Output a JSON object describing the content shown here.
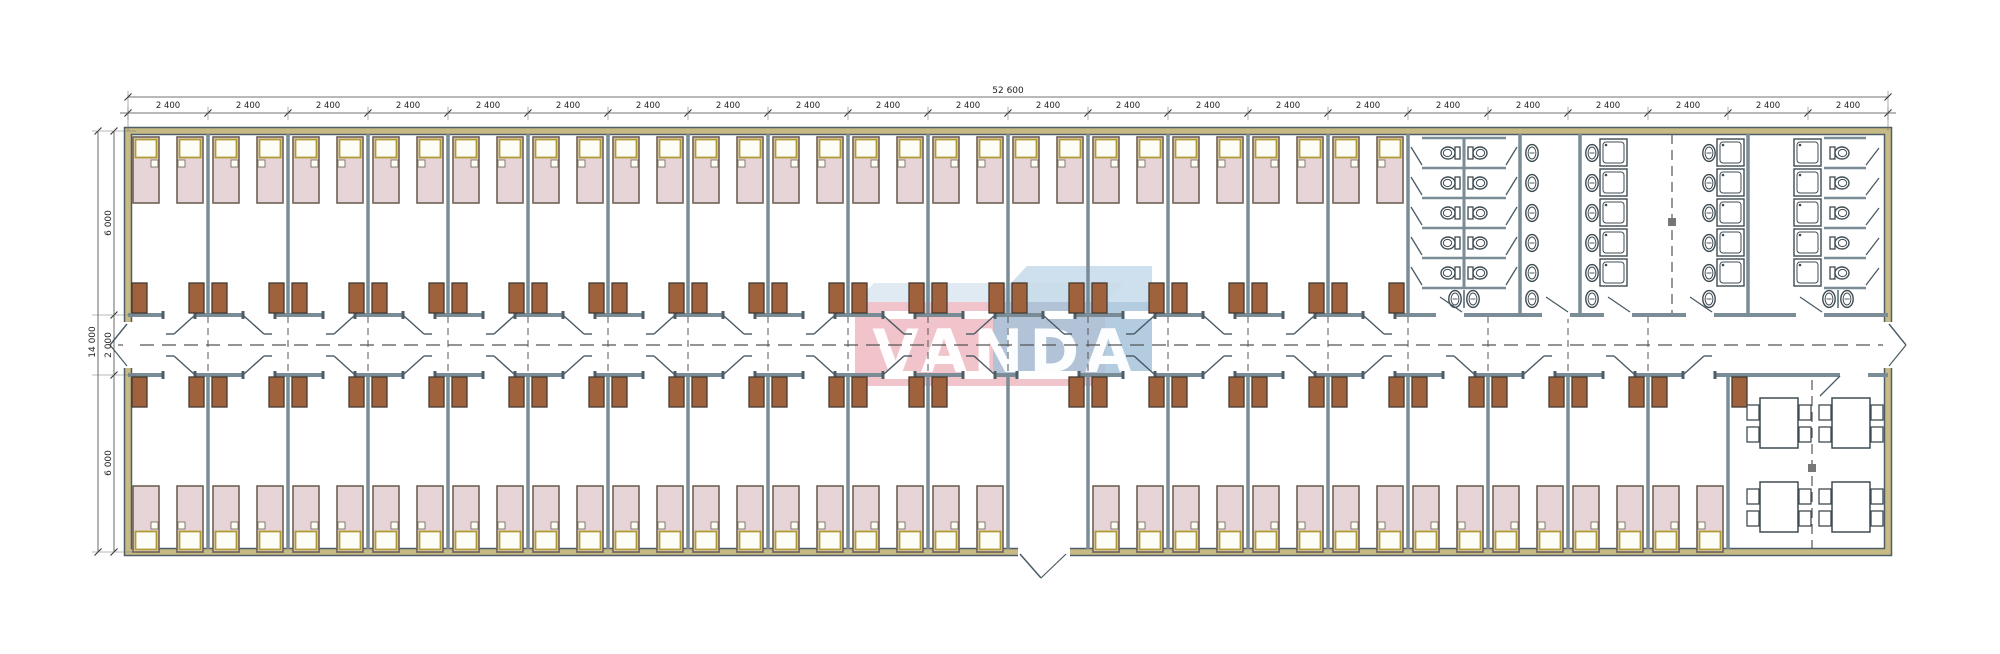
{
  "watermark": {
    "text": "VANDA",
    "pink_color": "#eeb9c1",
    "pink_top_color": "#d9e6f0",
    "blue_color": "#a7c3da",
    "blue_top_color": "#c6dbea"
  },
  "dimensions": {
    "top": {
      "total_label": "52 600",
      "segment_label": "2 400",
      "segment_count": 22
    },
    "left": {
      "total_label": "14 000",
      "segment_labels": [
        "6 000",
        "2 000",
        "6 000"
      ]
    }
  },
  "plan": {
    "module_count": 22,
    "top_bedroom_modules": 16,
    "bottom_bedroom_modules": 20,
    "entrance_module_index": 11,
    "beds_per_room": 2,
    "sanitary": {
      "wc_stall_rows": 5,
      "wc_back_to_back_per_row": 2,
      "washbasin_columns": 4,
      "basins_per_column": 5,
      "shower_columns": 3,
      "showers_per_column": 5
    },
    "dining": {
      "tables": 4,
      "chairs_per_table": 4
    },
    "colors": {
      "wall": "#7a8c96",
      "wall_dark": "#4e5e66",
      "wall_core": "#c7ba85",
      "line": "#4a5a64",
      "bed_blanket": "#e7d4d8",
      "bed_frame": "#6e6253",
      "pillow": "#fdfdf8",
      "pillow_frame": "#b09b35",
      "wardrobe": "#a0613d",
      "wardrobe_edge": "#43392f",
      "fixture": "#3f4b52",
      "dim": "#222222",
      "axis": "#555555"
    }
  }
}
